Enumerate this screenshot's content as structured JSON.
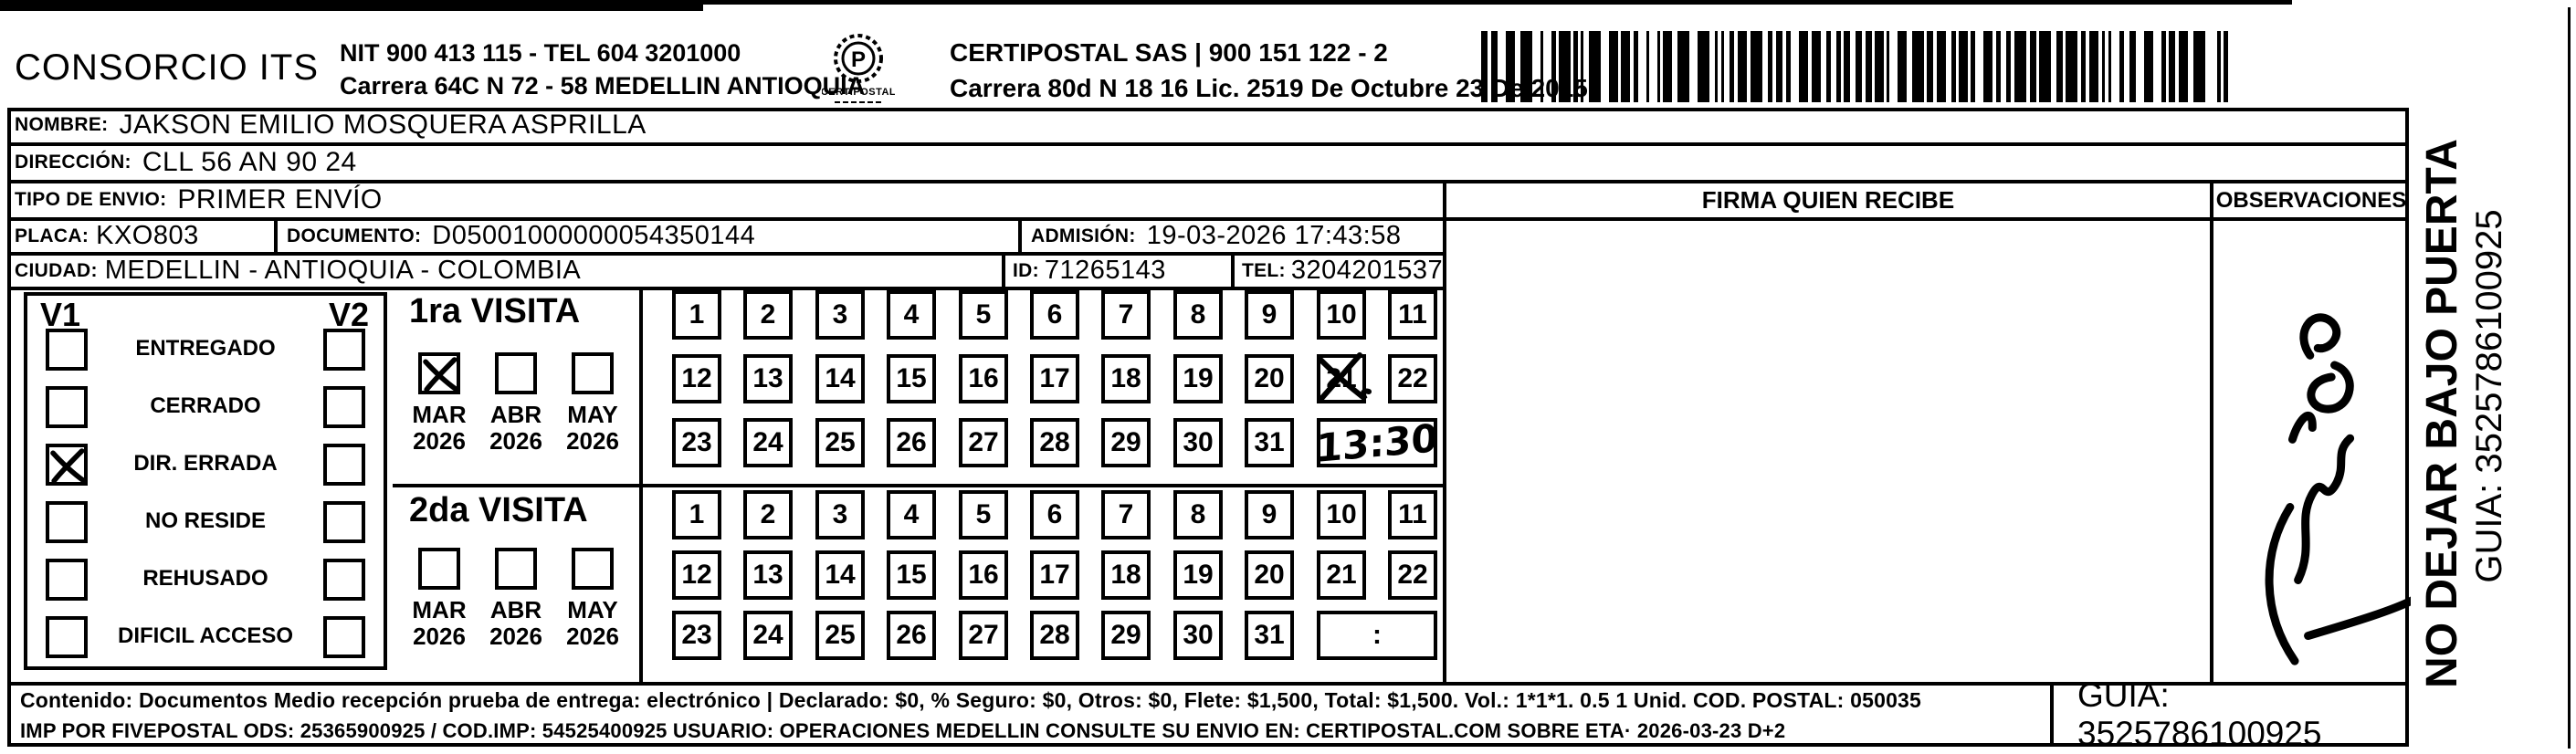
{
  "header": {
    "company": "CONSORCIO ITS",
    "company_nit": "NIT 900 413 115 - TEL 604 3201000",
    "company_address": "Carrera 64C N 72 - 58 MEDELLIN ANTIOQUIA",
    "logo_caption": "CERTIPOSTAL",
    "carrier_name": "CERTIPOSTAL SAS | 900 151 122 - 2",
    "carrier_license": "Carrera 80d N 18 16  Lic. 2519 De Octubre 23 De 2015"
  },
  "shipment": {
    "nombre_label": "NOMBRE:",
    "nombre_value": "JAKSON EMILIO MOSQUERA ASPRILLA",
    "direccion_label": "DIRECCIÓN:",
    "direccion_value": "CLL 56 AN 90 24",
    "tipo_label": "TIPO DE ENVIO:",
    "tipo_value": "PRIMER ENVÍO",
    "placa_label": "PLACA:",
    "placa_value": "KXO803",
    "documento_label": "DOCUMENTO:",
    "documento_value": "D05001000000054350144",
    "admision_label": "ADMISIÓN:",
    "admision_value": "19-03-2026 17:43:58",
    "ciudad_label": "CIUDAD:",
    "ciudad_value": "MEDELLIN - ANTIOQUIA - COLOMBIA",
    "id_label": "ID:",
    "id_value": "71265143",
    "tel_label": "TEL:",
    "tel_value": "3204201537"
  },
  "table_headers": {
    "firma": "FIRMA QUIEN RECIBE",
    "observaciones": "OBSERVACIONES"
  },
  "status_panel": {
    "col1": "V1",
    "col2": "V2",
    "options": [
      {
        "label": "ENTREGADO",
        "v1": false,
        "v2": false
      },
      {
        "label": "CERRADO",
        "v1": false,
        "v2": false
      },
      {
        "label": "DIR. ERRADA",
        "v1": true,
        "v2": false
      },
      {
        "label": "NO RESIDE",
        "v1": false,
        "v2": false
      },
      {
        "label": "REHUSADO",
        "v1": false,
        "v2": false
      },
      {
        "label": "DIFICIL ACCESO",
        "v1": false,
        "v2": false
      }
    ]
  },
  "visits": [
    {
      "title": "1ra VISITA",
      "months": [
        {
          "month": "MAR",
          "year": "2026",
          "checked": true
        },
        {
          "month": "ABR",
          "year": "2026",
          "checked": false
        },
        {
          "month": "MAY",
          "year": "2026",
          "checked": false
        }
      ],
      "day_rows": [
        [
          1,
          2,
          3,
          4,
          5,
          6,
          7,
          8,
          9,
          10,
          11
        ],
        [
          12,
          13,
          14,
          15,
          16,
          17,
          18,
          19,
          20,
          21,
          22
        ],
        [
          23,
          24,
          25,
          26,
          27,
          28,
          29,
          30,
          31
        ]
      ],
      "crossed_day": 21,
      "time_value": "13:30",
      "time_handwritten": true
    },
    {
      "title": "2da VISITA",
      "months": [
        {
          "month": "MAR",
          "year": "2026",
          "checked": false
        },
        {
          "month": "ABR",
          "year": "2026",
          "checked": false
        },
        {
          "month": "MAY",
          "year": "2026",
          "checked": false
        }
      ],
      "day_rows": [
        [
          1,
          2,
          3,
          4,
          5,
          6,
          7,
          8,
          9,
          10,
          11
        ],
        [
          12,
          13,
          14,
          15,
          16,
          17,
          18,
          19,
          20,
          21,
          22
        ],
        [
          23,
          24,
          25,
          26,
          27,
          28,
          29,
          30,
          31
        ]
      ],
      "crossed_day": null,
      "time_value": ":",
      "time_handwritten": false
    }
  ],
  "footer": {
    "line1": "Contenido: Documentos Medio recepción prueba de entrega: electrónico | Declarado: $0, % Seguro: $0, Otros: $0, Flete: $1,500, Total: $1,500. Vol.: 1*1*1. 0.5  1 Unid. COD. POSTAL: 050035",
    "line2": "IMP POR FIVEPOSTAL ODS: 25365900925 / COD.IMP: 54525400925 USUARIO: OPERACIONES MEDELLIN CONSULTE SU ENVIO EN: CERTIPOSTAL.COM SOBRE ETA· 2026-03-23 D+2",
    "guia": "GUIA: 3525786100925"
  },
  "side_panel": {
    "warning": "NO DEJAR BAJO PUERTA",
    "guia": "GUIA: 3525786100925"
  }
}
